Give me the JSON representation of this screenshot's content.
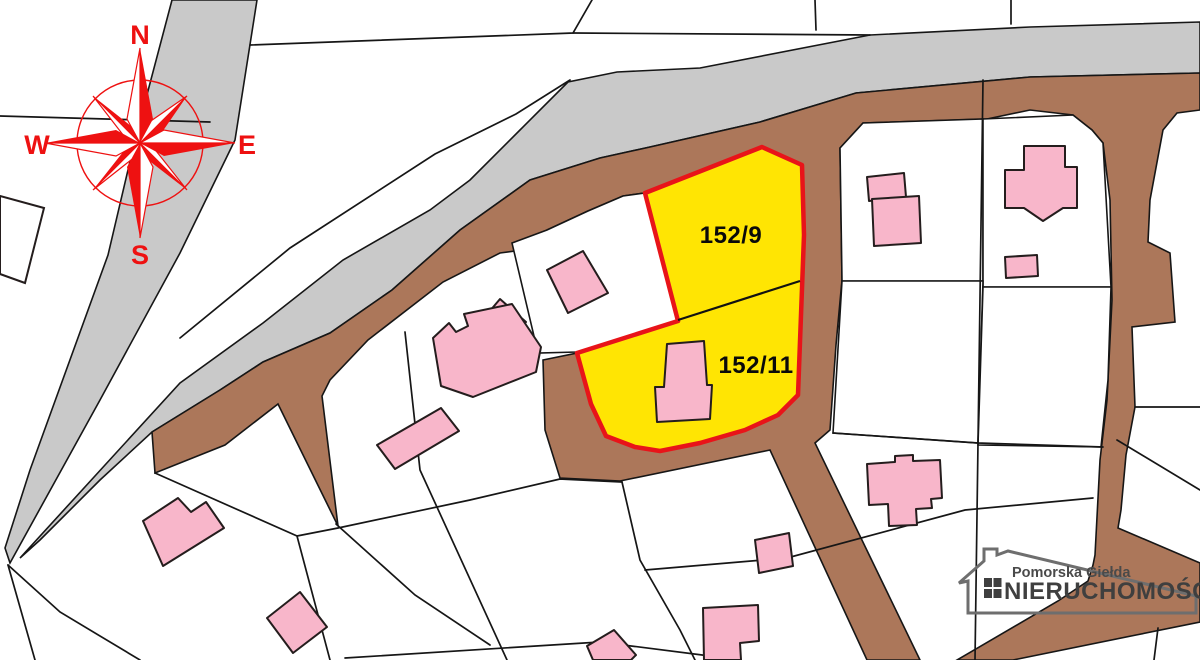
{
  "compass": {
    "n": "N",
    "e": "E",
    "s": "S",
    "w": "W"
  },
  "parcels": {
    "p9": {
      "label": "152/9"
    },
    "p11": {
      "label": "152/11"
    }
  },
  "logo": {
    "top": "Pomorska Giełda",
    "bottom": "NIERUCHOMOŚCI"
  },
  "colors": {
    "road-gray": "#c9c9c9",
    "road-brown": "#ac775a",
    "parcel-yellow": "#ffe503",
    "parcel-red": "#e81419",
    "building-pink": "#f8b6ca",
    "compass-red": "#ee1111",
    "line-black": "#161616",
    "logo-gray": "#6e6e6e",
    "logo-text": "#3f3f3f"
  }
}
